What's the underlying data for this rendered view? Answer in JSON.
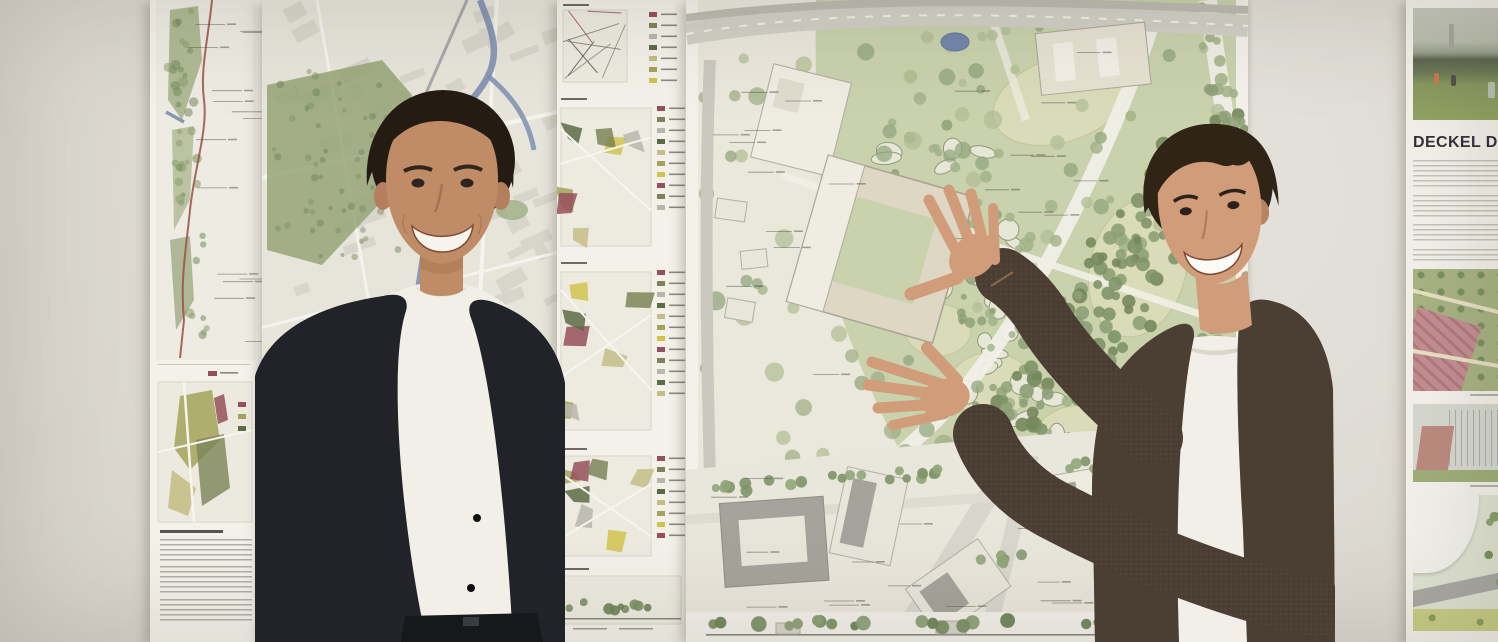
{
  "scene": {
    "alt": "Two smiling young presenters stand in front of a gallery wall pinned with urban design competition posters: a linear corridor map strip, a large city map, a column of colored analysis diagrams, a large landscape master plan with park, pond and tree clusters, and a poster titled DECKEL DRA with renders. The right man gestures at the master plan with both hands."
  },
  "deckel_poster": {
    "title": "DECKEL DRA"
  },
  "palette": {
    "wall": "#dcd8d0",
    "paper": "#f3f1ea",
    "map_bg": "#e7e5da",
    "plan_bg": "#eae7db",
    "block": "#d8d6cb",
    "street": "#f4f3ee",
    "green_light": "#c9d1ad",
    "green_mid": "#96a577",
    "lawn": "#dadcb9",
    "river": "#7e90b0",
    "pond": "#7487ac",
    "route_red": "#9c4f43",
    "maroon": "#96505a",
    "olive": "#a3a35c",
    "yellow": "#d0c44d",
    "ink": "#55544e",
    "title_ink": "#33323a",
    "building": "#ddd7c4",
    "building_white": "#efece1",
    "building_stroke": "#a9a394",
    "roof_grey": "#a5a49c",
    "skin_left": "#c08b67",
    "skin_right": "#d09c7a",
    "hair_left": "#241b12",
    "hair_right": "#302417",
    "jacket_left": "#212328",
    "jacket_right": "#4b3e33",
    "tee": "#f2efe8",
    "belt": "#17181b"
  },
  "artwork": {
    "panel_palette": [
      "#a3a35c",
      "#d0c44d",
      "#96505a",
      "#7c8556",
      "#b9b7ac",
      "#5d6b45",
      "#c4bd86"
    ],
    "panels": [
      {
        "y": 2,
        "h": 86,
        "map": {
          "x": 6,
          "y": 8,
          "w": 64,
          "h": 72
        },
        "rows": 7,
        "lx": 92,
        "style": "lines"
      },
      {
        "y": 96,
        "h": 156,
        "map": {
          "x": 4,
          "y": 12,
          "w": 90,
          "h": 138
        },
        "rows": 10,
        "lx": 100,
        "style": "poly"
      },
      {
        "y": 260,
        "h": 178,
        "map": {
          "x": 4,
          "y": 12,
          "w": 90,
          "h": 158
        },
        "rows": 12,
        "lx": 100,
        "style": "poly"
      },
      {
        "y": 446,
        "h": 114,
        "map": {
          "x": 4,
          "y": 10,
          "w": 90,
          "h": 100
        },
        "rows": 8,
        "lx": 100,
        "style": "poly"
      },
      {
        "y": 566,
        "h": 74,
        "map": {
          "x": 6,
          "y": 10,
          "w": 118,
          "h": 48
        },
        "rows": 0,
        "lx": 100,
        "style": "section"
      }
    ],
    "tree_zones": {
      "plan_park": {
        "seed": 11,
        "mode": "rect",
        "x": 250,
        "y": 15,
        "w": 290,
        "h": 230,
        "count": 55,
        "rmin": 4,
        "rmax": 8,
        "palette": [
          "#a2b186",
          "#b3bf97",
          "#95a67c"
        ],
        "opacity": 0.8
      },
      "plan_left": {
        "seed": 23,
        "mode": "rect",
        "x": 18,
        "y": 30,
        "w": 290,
        "h": 430,
        "count": 60,
        "rmin": 5,
        "rmax": 10,
        "palette": [
          "#9cab81",
          "#8da27a",
          "#b0bc93"
        ],
        "opacity": 0.7
      },
      "plan_band": {
        "seed": 37,
        "mode": "band",
        "x1": 530,
        "y1": 150,
        "x2": 290,
        "y2": 480,
        "spread": 85,
        "count": 150,
        "rmin": 4,
        "rmax": 8,
        "palette": [
          "#7f9468",
          "#8da077",
          "#76885c"
        ],
        "opacity": 0.9
      },
      "plan_cells_trees": {
        "seed": 51,
        "mode": "band",
        "x1": 220,
        "y1": 150,
        "x2": 360,
        "y2": 440,
        "spread": 120,
        "count": 70,
        "rmin": 3,
        "rmax": 6,
        "palette": [
          "#8ba073",
          "#9fb287"
        ],
        "opacity": 0.8
      },
      "plan_right": {
        "seed": 63,
        "mode": "rect",
        "x": 515,
        "y": 0,
        "w": 45,
        "h": 420,
        "count": 34,
        "rmin": 4,
        "rmax": 7,
        "palette": [
          "#8da077",
          "#a2b186"
        ],
        "opacity": 0.85
      },
      "plan_row_a": {
        "seed": 71,
        "mode": "band",
        "x1": 30,
        "y1": 489,
        "x2": 260,
        "y2": 472,
        "spread": 10,
        "count": 22,
        "rmin": 4,
        "rmax": 6,
        "palette": [
          "#90a578",
          "#7f9468"
        ],
        "opacity": 0.9
      },
      "plan_row_b": {
        "seed": 77,
        "mode": "band",
        "x1": 330,
        "y1": 470,
        "x2": 548,
        "y2": 452,
        "spread": 12,
        "count": 20,
        "rmin": 4,
        "rmax": 6,
        "palette": [
          "#90a578",
          "#7f9468"
        ],
        "opacity": 0.9
      },
      "plan_row_c": {
        "seed": 83,
        "mode": "band",
        "x1": 300,
        "y1": 560,
        "x2": 548,
        "y2": 545,
        "spread": 12,
        "count": 18,
        "rmin": 4,
        "rmax": 6,
        "palette": [
          "#90a578",
          "#869970"
        ],
        "opacity": 0.9
      },
      "plan_section": {
        "seed": 91,
        "mode": "band",
        "x1": 30,
        "y1": 624,
        "x2": 540,
        "y2": 624,
        "spread": 8,
        "count": 26,
        "rmin": 4,
        "rmax": 8,
        "palette": [
          "#7d9166",
          "#6f8459",
          "#8da077"
        ],
        "opacity": 0.95
      },
      "city_green": {
        "seed": 101,
        "mode": "rect",
        "x": 12,
        "y": 70,
        "w": 125,
        "h": 190,
        "count": 55,
        "rmin": 2,
        "rmax": 4,
        "palette": [
          "#7e9162",
          "#6f8459"
        ],
        "opacity": 0.5
      },
      "city_green2": {
        "seed": 107,
        "mode": "rect",
        "x": 8,
        "y": 470,
        "w": 80,
        "h": 150,
        "count": 30,
        "rmin": 2,
        "rmax": 4,
        "palette": [
          "#7e9162",
          "#6f8459"
        ],
        "opacity": 0.45
      },
      "corridor_green": {
        "seed": 113,
        "mode": "band",
        "x1": 28,
        "y1": 20,
        "x2": 46,
        "y2": 330,
        "spread": 26,
        "count": 40,
        "rmin": 2,
        "rmax": 5,
        "palette": [
          "#8a9e6e",
          "#768a5c"
        ],
        "opacity": 0.55
      }
    },
    "cells": {
      "seed": 131,
      "x1": 230,
      "y1": 160,
      "x2": 340,
      "y2": 430,
      "spread": 110,
      "count": 42,
      "fill": "#e6e7d6",
      "stroke": "#8f9b78"
    },
    "blocks": {
      "city": {
        "seed": 141,
        "x": 6,
        "y": 4,
        "w": 282,
        "h": 630,
        "count": 95,
        "minw": 10,
        "maxw": 34,
        "minh": 7,
        "maxh": 16,
        "rot": -22,
        "jit": 14,
        "fill": "#d8d6cb"
      }
    },
    "leaders": {
      "plan_left": {
        "seed": 151,
        "x": 25,
        "y": 60,
        "w": 120,
        "h": 440,
        "count": 13,
        "len": 26
      },
      "plan_park": {
        "seed": 157,
        "x": 260,
        "y": 35,
        "w": 220,
        "h": 260,
        "count": 11,
        "len": 24
      },
      "plan_bottom": {
        "seed": 163,
        "x": 60,
        "y": 495,
        "w": 380,
        "h": 100,
        "count": 8,
        "len": 22
      },
      "corridor": {
        "seed": 167,
        "x": 38,
        "y": 15,
        "w": 58,
        "h": 330,
        "count": 15,
        "len": 30
      },
      "section": {
        "seed": 173,
        "x": 60,
        "y": 600,
        "w": 420,
        "h": 8,
        "count": 6,
        "len": 30
      }
    }
  }
}
